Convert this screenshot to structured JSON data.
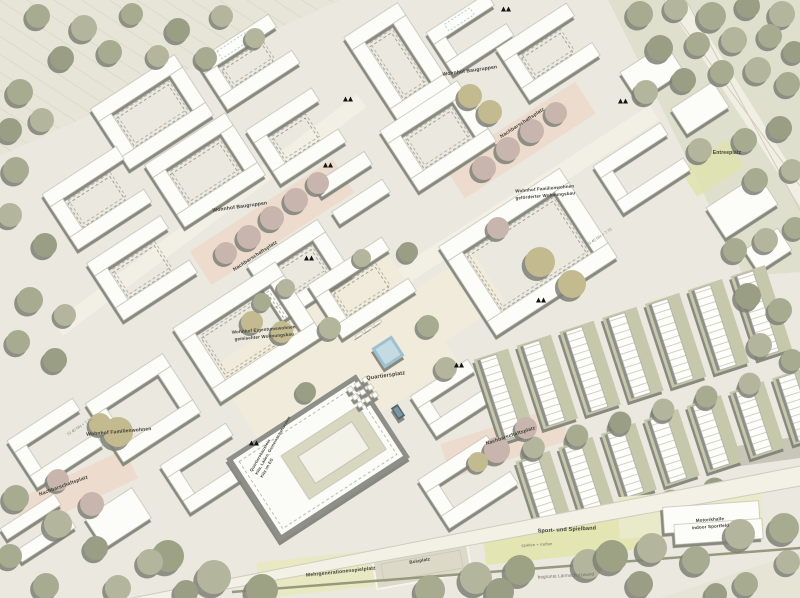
{
  "map": {
    "kind": "urban masterplan site plan",
    "colors": {
      "background": "#eae8df",
      "building_white": "#fcfcf8",
      "building_wall": "#8d8f88",
      "tree_olive": "#a7ab90",
      "tree_pink": "#c8b6ae",
      "tree_khaki": "#c3ba90",
      "plaza_pink": "#eddccd",
      "plaza_cream": "#f1ebdb",
      "water_blue": "#9fc0cf",
      "sport_green": "#e3e5b2",
      "field_stripe": "#e7e5d7"
    },
    "labels": {
      "wohnhof_baugruppen_top": "Wohnhof Baugruppen",
      "nachbarschaftsplatz_top": "Nachbarschaftsplatz",
      "entreeplatz": "Entreeplatz",
      "wohnhof_baugruppen_left": "Wohnhof Baugruppen",
      "nachbarschaftsplatz_left": "Nachbarschaftsplatz",
      "wohnhof_eigentum_line1": "Wohnhof Eigentumswohnen",
      "wohnhof_eigentum_line2": "gemischter Wohnungsbau",
      "wohnhof_gefoerdert_line1": "Wohnhof Familienwohnen",
      "wohnhof_gefoerdert_line2": "geförderter Wohnungsbau",
      "quartiersplatz": "Quartiersplatz",
      "nachbarschaftsplatz_mid": "Nachbarschaftsplatz",
      "wohnhof_familienwohnen": "Wohnhof Familienwohnen",
      "nachbarschaftsplatz_sw": "Nachbarschaftsplatz",
      "quartiersbaustein_line1": "Quartiersbaustein",
      "quartiersbaustein_line2": "Kita, Läden, Gemeinschaftsraum",
      "quartiersbaustein_line3": "Kita im EG",
      "sportband": "Sport- und Spielband",
      "spielen_treffen": "spielen + treffen",
      "laermschutzwand": "begrünte Lärmschutzwand",
      "mehrgenerationenspielplatz": "Mehrgenerationenspielplatz",
      "bolzplatz": "Bolzplatz",
      "motorikhalle_line1": "Motorikhalle",
      "motorikhalle_line2": "indoor Sportfeld",
      "street_elevation_1": "70.40 NN + 7.70",
      "street_elevation_2": "70.40 NN + 7.70"
    }
  }
}
